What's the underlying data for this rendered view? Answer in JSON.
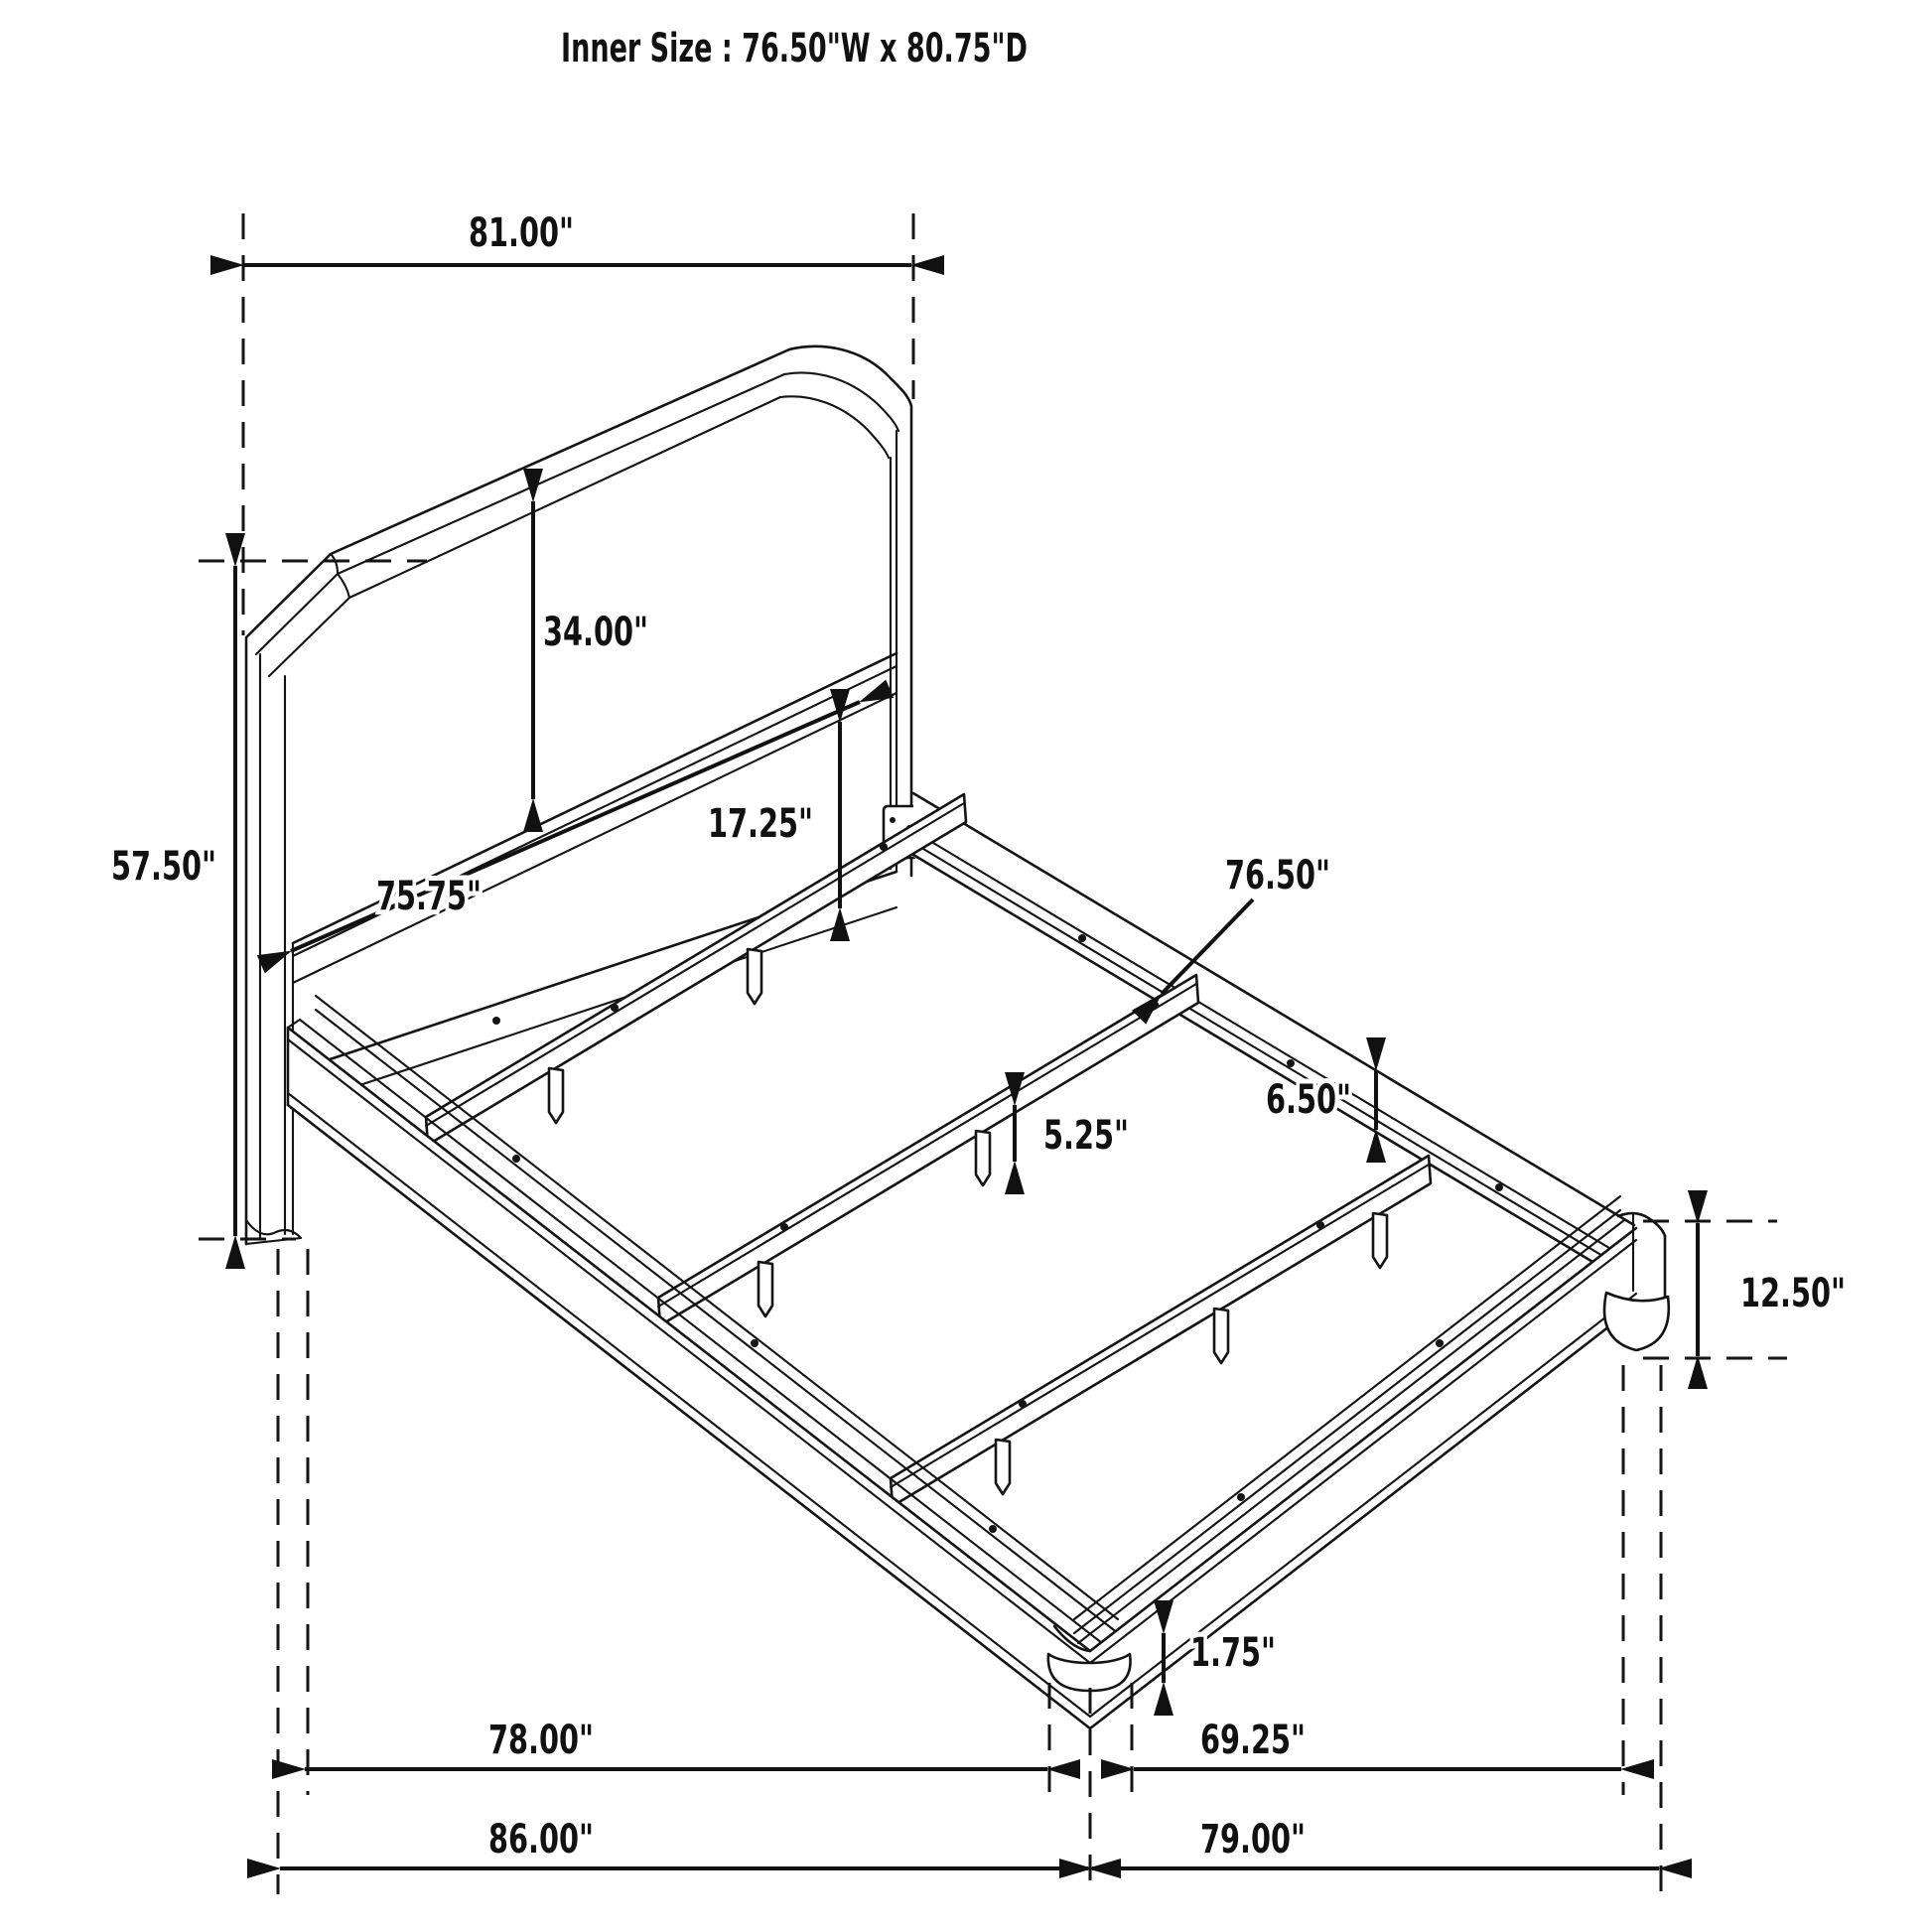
{
  "title": "Inner Size : 76.50\"W x 80.75\"D",
  "dims": {
    "headboard_width": "81.00\"",
    "headboard_height": "57.50\"",
    "headboard_panel_height": "34.00\"",
    "headboard_to_rail_bottom": "17.25\"",
    "headboard_inner_width": "75.75\"",
    "slat_length": "76.50\"",
    "side_rail_height": "6.50\"",
    "slat_leg_height": "5.25\"",
    "footboard_corner_height": "12.50\"",
    "foot_height": "1.75\"",
    "side_rail_length": "78.00\"",
    "footboard_inner_span": "69.25\"",
    "overall_depth": "86.00\"",
    "overall_width": "79.00\""
  }
}
